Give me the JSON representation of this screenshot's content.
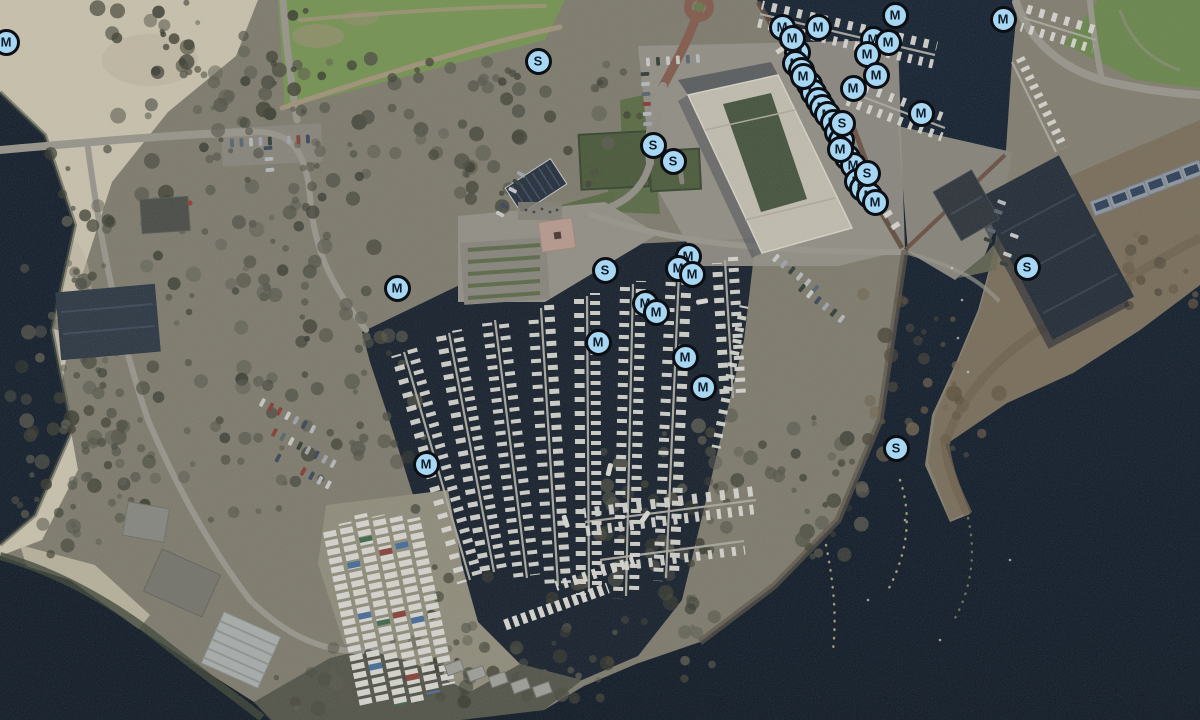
{
  "map": {
    "width": 1200,
    "height": 720,
    "marker_fill": "#a7d7f3",
    "marker_border": "#0b0e13",
    "marker_letter_color": "#0d1a28",
    "markers": [
      {
        "label": "M",
        "x": 797,
        "y": 52
      },
      {
        "label": "M",
        "x": 795,
        "y": 63
      },
      {
        "label": "M",
        "x": 801,
        "y": 70
      },
      {
        "label": "M",
        "x": 809,
        "y": 84
      },
      {
        "label": "M",
        "x": 813,
        "y": 92
      },
      {
        "label": "M",
        "x": 818,
        "y": 100
      },
      {
        "label": "M",
        "x": 822,
        "y": 107
      },
      {
        "label": "M",
        "x": 827,
        "y": 114
      },
      {
        "label": "M",
        "x": 833,
        "y": 122
      },
      {
        "label": "M",
        "x": 837,
        "y": 132
      },
      {
        "label": "M",
        "x": 841,
        "y": 140
      },
      {
        "label": "M",
        "x": 847,
        "y": 157
      },
      {
        "label": "M",
        "x": 853,
        "y": 165
      },
      {
        "label": "M",
        "x": 857,
        "y": 181
      },
      {
        "label": "M",
        "x": 862,
        "y": 188
      },
      {
        "label": "M",
        "x": 869,
        "y": 195
      },
      {
        "label": "M",
        "x": 6,
        "y": 42
      },
      {
        "label": "S",
        "x": 538,
        "y": 61
      },
      {
        "label": "S",
        "x": 653,
        "y": 145
      },
      {
        "label": "S",
        "x": 673,
        "y": 161
      },
      {
        "label": "M",
        "x": 782,
        "y": 27
      },
      {
        "label": "M",
        "x": 818,
        "y": 27
      },
      {
        "label": "M",
        "x": 895,
        "y": 15
      },
      {
        "label": "M",
        "x": 1003,
        "y": 19
      },
      {
        "label": "M",
        "x": 873,
        "y": 39
      },
      {
        "label": "M",
        "x": 888,
        "y": 42
      },
      {
        "label": "M",
        "x": 867,
        "y": 54
      },
      {
        "label": "M",
        "x": 792,
        "y": 38
      },
      {
        "label": "M",
        "x": 803,
        "y": 76
      },
      {
        "label": "M",
        "x": 876,
        "y": 75
      },
      {
        "label": "M",
        "x": 853,
        "y": 88
      },
      {
        "label": "S",
        "x": 842,
        "y": 123
      },
      {
        "label": "M",
        "x": 840,
        "y": 149
      },
      {
        "label": "S",
        "x": 867,
        "y": 173
      },
      {
        "label": "M",
        "x": 875,
        "y": 202
      },
      {
        "label": "M",
        "x": 921,
        "y": 113
      },
      {
        "label": "S",
        "x": 1027,
        "y": 267
      },
      {
        "label": "M",
        "x": 397,
        "y": 288
      },
      {
        "label": "S",
        "x": 605,
        "y": 270
      },
      {
        "label": "M",
        "x": 688,
        "y": 256
      },
      {
        "label": "M",
        "x": 678,
        "y": 268
      },
      {
        "label": "M",
        "x": 692,
        "y": 274
      },
      {
        "label": "M",
        "x": 645,
        "y": 303
      },
      {
        "label": "M",
        "x": 656,
        "y": 312
      },
      {
        "label": "M",
        "x": 598,
        "y": 342
      },
      {
        "label": "M",
        "x": 685,
        "y": 357
      },
      {
        "label": "M",
        "x": 703,
        "y": 387
      },
      {
        "label": "M",
        "x": 426,
        "y": 464
      },
      {
        "label": "S",
        "x": 896,
        "y": 448
      }
    ]
  }
}
